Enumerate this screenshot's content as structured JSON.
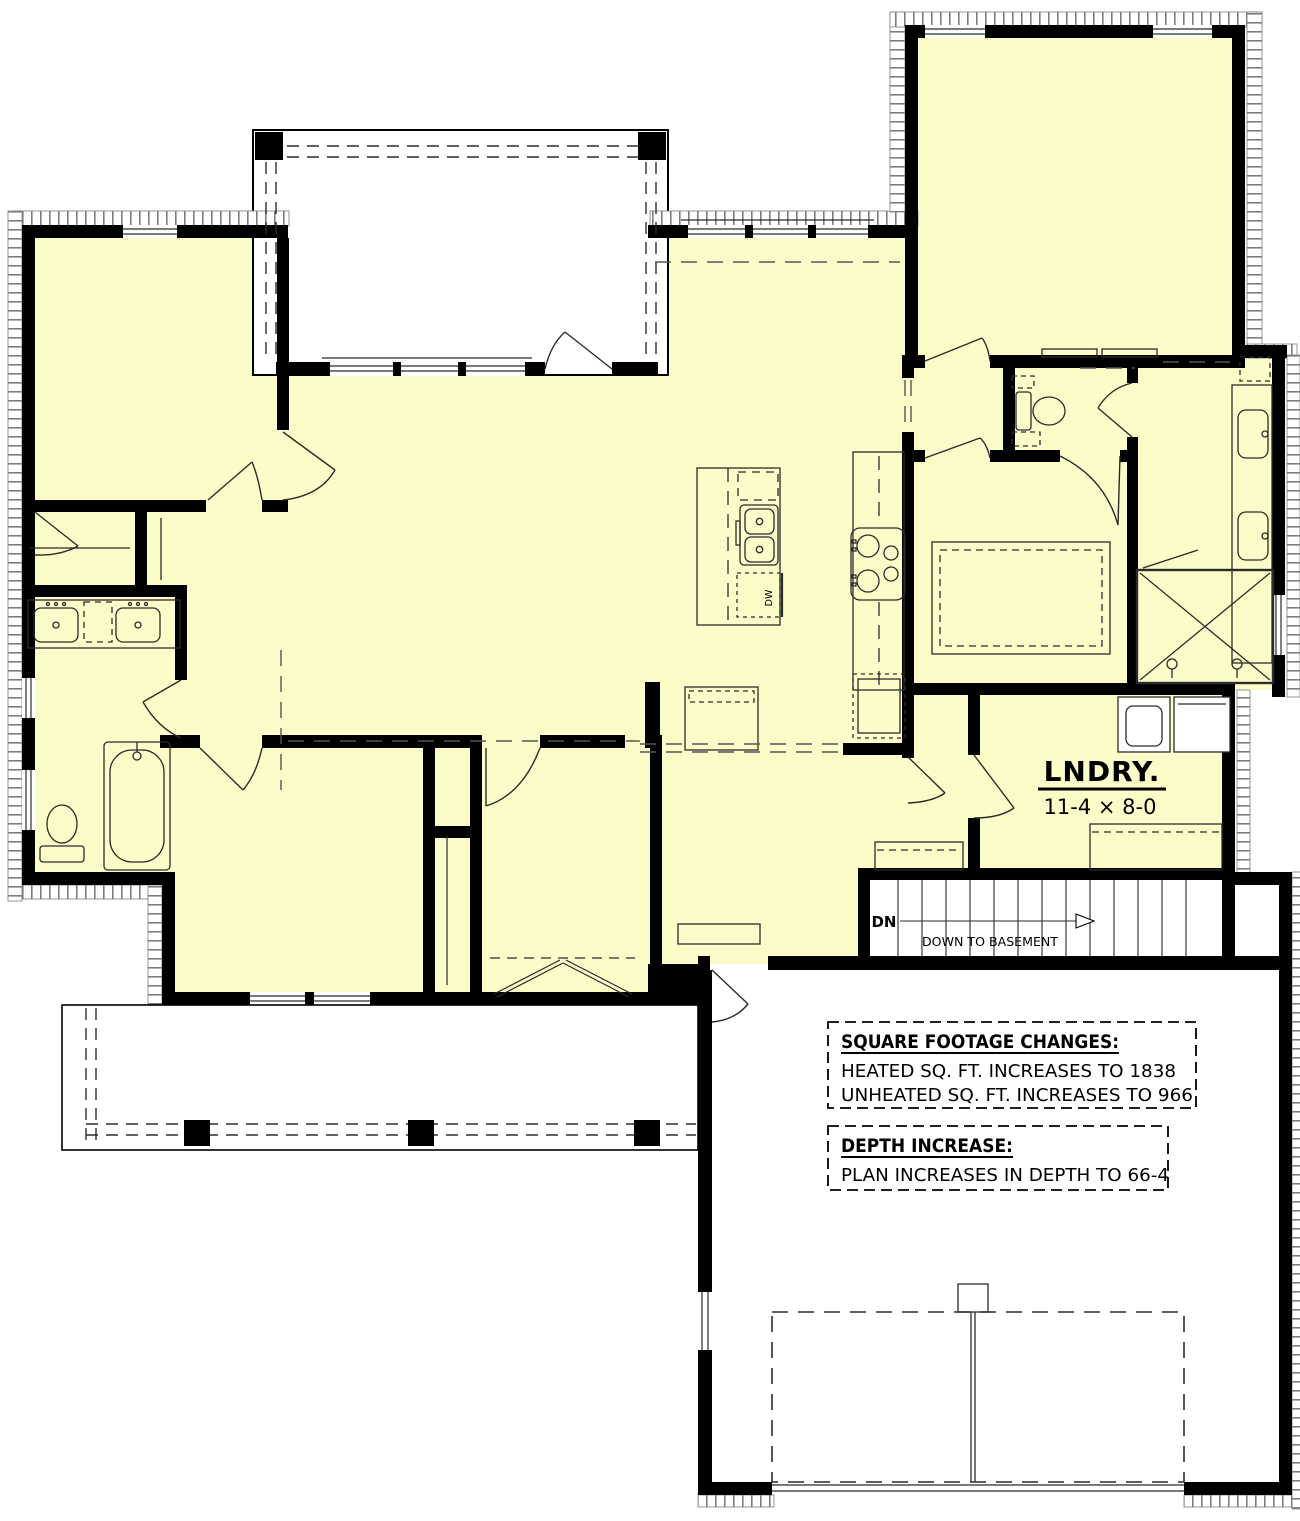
{
  "colors": {
    "heated": "#FCFCC9",
    "unheated": "#FFFFFF",
    "wall": "#000000",
    "line": "#2b2b2b",
    "hatch": "#7d7d7d"
  },
  "rooms": {
    "laundry": {
      "label": "LNDRY.",
      "dims": "11-4 × 8-0"
    }
  },
  "stairs": {
    "direction_label": "DN",
    "description": "DOWN TO BASEMENT"
  },
  "kitchen": {
    "dishwasher_label": "DW"
  },
  "notes": [
    {
      "title": "SQUARE FOOTAGE CHANGES:",
      "lines": [
        "HEATED SQ. FT. INCREASES TO 1838",
        "UNHEATED SQ. FT. INCREASES TO 966"
      ]
    },
    {
      "title": "DEPTH INCREASE:",
      "lines": [
        "PLAN INCREASES IN DEPTH TO 66-4"
      ]
    }
  ]
}
